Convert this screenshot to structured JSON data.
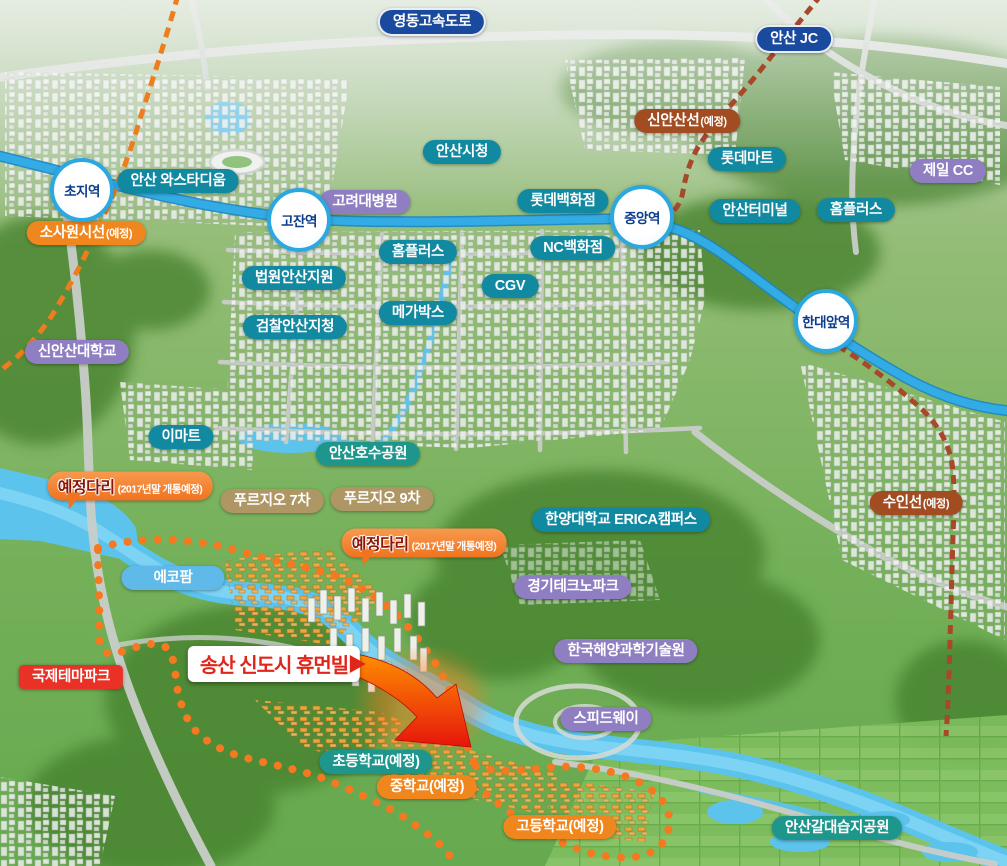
{
  "map": {
    "title_box": {
      "text": "송산 신도시 휴먼빌"
    },
    "palette": {
      "teal": "#1189A0",
      "tealGreen": "#1E968C",
      "purple": "#8F7FC2",
      "navy": "#1A4A9E",
      "orange": "#F0861E",
      "rust": "#A24C22",
      "tan": "#AE9764",
      "skyblue": "#5FB9E9",
      "red": "#E93125",
      "bridgeOrange": "#F0731F",
      "stationRing": "#2BA8E0",
      "stationText": "#0C3C8C",
      "metroLine": "#33ABE4",
      "titleRed": "#E1251B",
      "boundaryOrange": "#F47920"
    },
    "stations": [
      {
        "id": "choji-station",
        "text": "초지역",
        "x": 82,
        "y": 190
      },
      {
        "id": "gojan-station",
        "text": "고잔역",
        "x": 299,
        "y": 220
      },
      {
        "id": "jungang-station",
        "text": "중앙역",
        "x": 642,
        "y": 217
      },
      {
        "id": "handaeap-station",
        "text": "한대앞역",
        "x": 826,
        "y": 321
      }
    ],
    "labels": [
      {
        "id": "yeongdong-expressway",
        "text": "영동고속도로",
        "suffix": "",
        "type": "navy",
        "x": 432,
        "y": 22
      },
      {
        "id": "ansan-jc",
        "text": "안산 JC",
        "suffix": "",
        "type": "navy",
        "x": 794,
        "y": 39
      },
      {
        "id": "sin-ansan-line",
        "text": "신안산선",
        "suffix": "(예정)",
        "type": "rust",
        "x": 687,
        "y": 121
      },
      {
        "id": "lotte-mart",
        "text": "롯데마트",
        "suffix": "",
        "type": "teal",
        "x": 747,
        "y": 159
      },
      {
        "id": "jeil-cc",
        "text": "제일 CC",
        "suffix": "",
        "type": "purple",
        "x": 948,
        "y": 171
      },
      {
        "id": "ansan-wa-stadium",
        "text": "안산 와스타디움",
        "suffix": "",
        "type": "teal",
        "x": 178,
        "y": 181
      },
      {
        "id": "ansan-city-hall",
        "text": "안산시청",
        "suffix": "",
        "type": "teal",
        "x": 462,
        "y": 152
      },
      {
        "id": "korea-univ-hospital",
        "text": "고려대병원",
        "suffix": "",
        "type": "purple",
        "x": 365,
        "y": 202
      },
      {
        "id": "lotte-department-store",
        "text": "롯데백화점",
        "suffix": "",
        "type": "teal",
        "x": 563,
        "y": 201
      },
      {
        "id": "ansan-terminal",
        "text": "안산터미널",
        "suffix": "",
        "type": "teal",
        "x": 755,
        "y": 211
      },
      {
        "id": "homeplus-east",
        "text": "홈플러스",
        "suffix": "",
        "type": "teal",
        "x": 856,
        "y": 210
      },
      {
        "id": "sosa-wonsi-line",
        "text": "소사원시선",
        "suffix": "(예정)",
        "type": "orange",
        "x": 86,
        "y": 233
      },
      {
        "id": "homeplus-center",
        "text": "홈플러스",
        "suffix": "",
        "type": "teal",
        "x": 418,
        "y": 252
      },
      {
        "id": "nc-department-store",
        "text": "NC백화점",
        "suffix": "",
        "type": "teal",
        "x": 573,
        "y": 248
      },
      {
        "id": "court-ansan-branch",
        "text": "법원안산지원",
        "suffix": "",
        "type": "teal",
        "x": 294,
        "y": 278
      },
      {
        "id": "cgv",
        "text": "CGV",
        "suffix": "",
        "type": "teal",
        "x": 510,
        "y": 286
      },
      {
        "id": "megabox",
        "text": "메가박스",
        "suffix": "",
        "type": "teal",
        "x": 418,
        "y": 313
      },
      {
        "id": "prosecutors-ansan-branch",
        "text": "검찰안산지청",
        "suffix": "",
        "type": "teal",
        "x": 295,
        "y": 327
      },
      {
        "id": "sin-ansan-university",
        "text": "신안산대학교",
        "suffix": "",
        "type": "purple",
        "x": 77,
        "y": 352
      },
      {
        "id": "emart",
        "text": "이마트",
        "suffix": "",
        "type": "teal",
        "x": 181,
        "y": 437
      },
      {
        "id": "ansan-lake-park",
        "text": "안산호수공원",
        "suffix": "",
        "type": "tealGreen",
        "x": 368,
        "y": 454
      },
      {
        "id": "prugio-7",
        "text": "푸르지오 7차",
        "suffix": "",
        "type": "tan",
        "x": 272,
        "y": 501
      },
      {
        "id": "prugio-9",
        "text": "푸르지오 9차",
        "suffix": "",
        "type": "tan",
        "x": 382,
        "y": 499
      },
      {
        "id": "hanyang-univ-erica",
        "text": "한양대학교 ERICA캠퍼스",
        "suffix": "",
        "type": "teal",
        "x": 621,
        "y": 520
      },
      {
        "id": "suin-line",
        "text": "수인선",
        "suffix": "(예정)",
        "type": "rust",
        "x": 916,
        "y": 503
      },
      {
        "id": "eco-farm",
        "text": "에코팜",
        "suffix": "",
        "type": "skyblue",
        "x": 173,
        "y": 578
      },
      {
        "id": "gyeonggi-technopark",
        "text": "경기테크노파크",
        "suffix": "",
        "type": "purple",
        "x": 573,
        "y": 587
      },
      {
        "id": "kiost",
        "text": "한국해양과학기술원",
        "suffix": "",
        "type": "purple",
        "x": 626,
        "y": 651
      },
      {
        "id": "international-theme-park",
        "text": "국제테마파크",
        "suffix": "",
        "type": "red",
        "x": 71,
        "y": 677
      },
      {
        "id": "speedway",
        "text": "스피드웨이",
        "suffix": "",
        "type": "purple",
        "x": 606,
        "y": 719
      },
      {
        "id": "elementary-school",
        "text": "초등학교(예정)",
        "suffix": "",
        "type": "tealGreen",
        "x": 376,
        "y": 762
      },
      {
        "id": "middle-school",
        "text": "중학교(예정)",
        "suffix": "",
        "type": "orange",
        "x": 427,
        "y": 787
      },
      {
        "id": "high-school",
        "text": "고등학교(예정)",
        "suffix": "",
        "type": "orange",
        "x": 560,
        "y": 827
      },
      {
        "id": "ansan-reed-wetland-park",
        "text": "안산갈대습지공원",
        "suffix": "",
        "type": "tealGreen",
        "x": 837,
        "y": 828
      }
    ],
    "bridge_labels": [
      {
        "id": "planned-bridge-west",
        "text": "예정다리",
        "suffix": "(2017년말 개통예정)",
        "x": 130,
        "y": 486
      },
      {
        "id": "planned-bridge-center",
        "text": "예정다리",
        "suffix": "(2017년말 개통예정)",
        "x": 424,
        "y": 543
      }
    ]
  }
}
